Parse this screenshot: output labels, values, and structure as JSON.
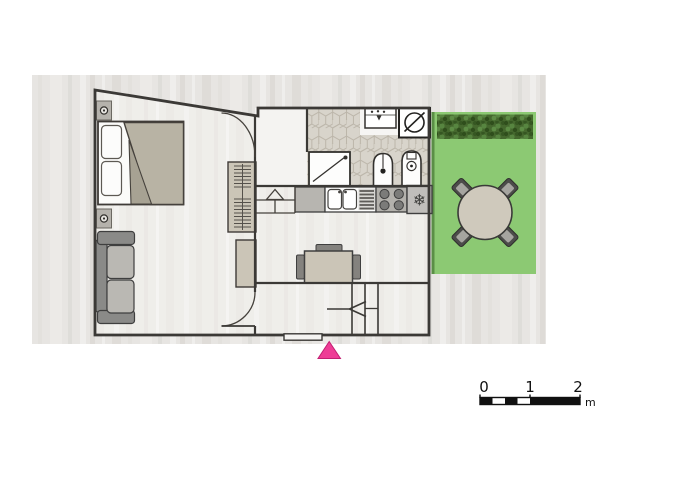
{
  "image": {
    "type": "apartment-floor-plan",
    "description": "Top-down floor plan of a small apartment on a light wood background with a garden terrace on the right and an entrance marker at the bottom"
  },
  "scale_bar": {
    "ticks": [
      "0",
      "1",
      "2"
    ],
    "unit": "m"
  },
  "colors": {
    "wall": "#3b3936",
    "garden": "#8cc973",
    "garden_edge": "#5a8f46",
    "hedge": "#45682e",
    "entrance_marker": "#ee3d96",
    "entrance_marker_edge": "#c21f72",
    "outer_floor": "#e7e5e2",
    "room_floor": "#efeeea",
    "hall_floor": "#f4f3f1",
    "tile_base": "#d8d4cb",
    "tile_line": "#bcb6aa",
    "furniture_beige": "#cbc5b7",
    "duvet": "#b8b3a4",
    "duvet_fold": "#a7a293",
    "sofa_frame": "#8a8a88",
    "sofa_cushion": "#bab8b3",
    "counter": "#b7b5b0",
    "chair_dark": "#84827e",
    "garden_chair": "#4c4c4a",
    "garden_table": "#cfc9bc"
  },
  "rooms": [
    {
      "name": "bedroom-living"
    },
    {
      "name": "hall"
    },
    {
      "name": "bathroom"
    },
    {
      "name": "kitchen-dining"
    },
    {
      "name": "entry-hall"
    },
    {
      "name": "garden-terrace"
    }
  ],
  "icons": {
    "bedroom": [
      "wall-light",
      "double-bed",
      "pillow",
      "duvet",
      "sofa",
      "wardrobe-hanging-rail",
      "cabinet"
    ],
    "bathroom": [
      "washbasin",
      "washing-machine",
      "shower-tray",
      "toilet",
      "bidet"
    ],
    "kitchen": [
      "corner-cabinet",
      "double-sink",
      "dish-drainer",
      "stove-4-burners",
      "fridge-snowflake"
    ],
    "dining": [
      "dining-table",
      "dining-chair"
    ],
    "garden": [
      "hedge",
      "round-garden-table",
      "garden-chair"
    ],
    "circulation": [
      "door-swing-arc",
      "steps-up-arrow",
      "staircase",
      "stair-direction-arrow",
      "entrance-threshold",
      "entrance-marker-triangle"
    ]
  }
}
